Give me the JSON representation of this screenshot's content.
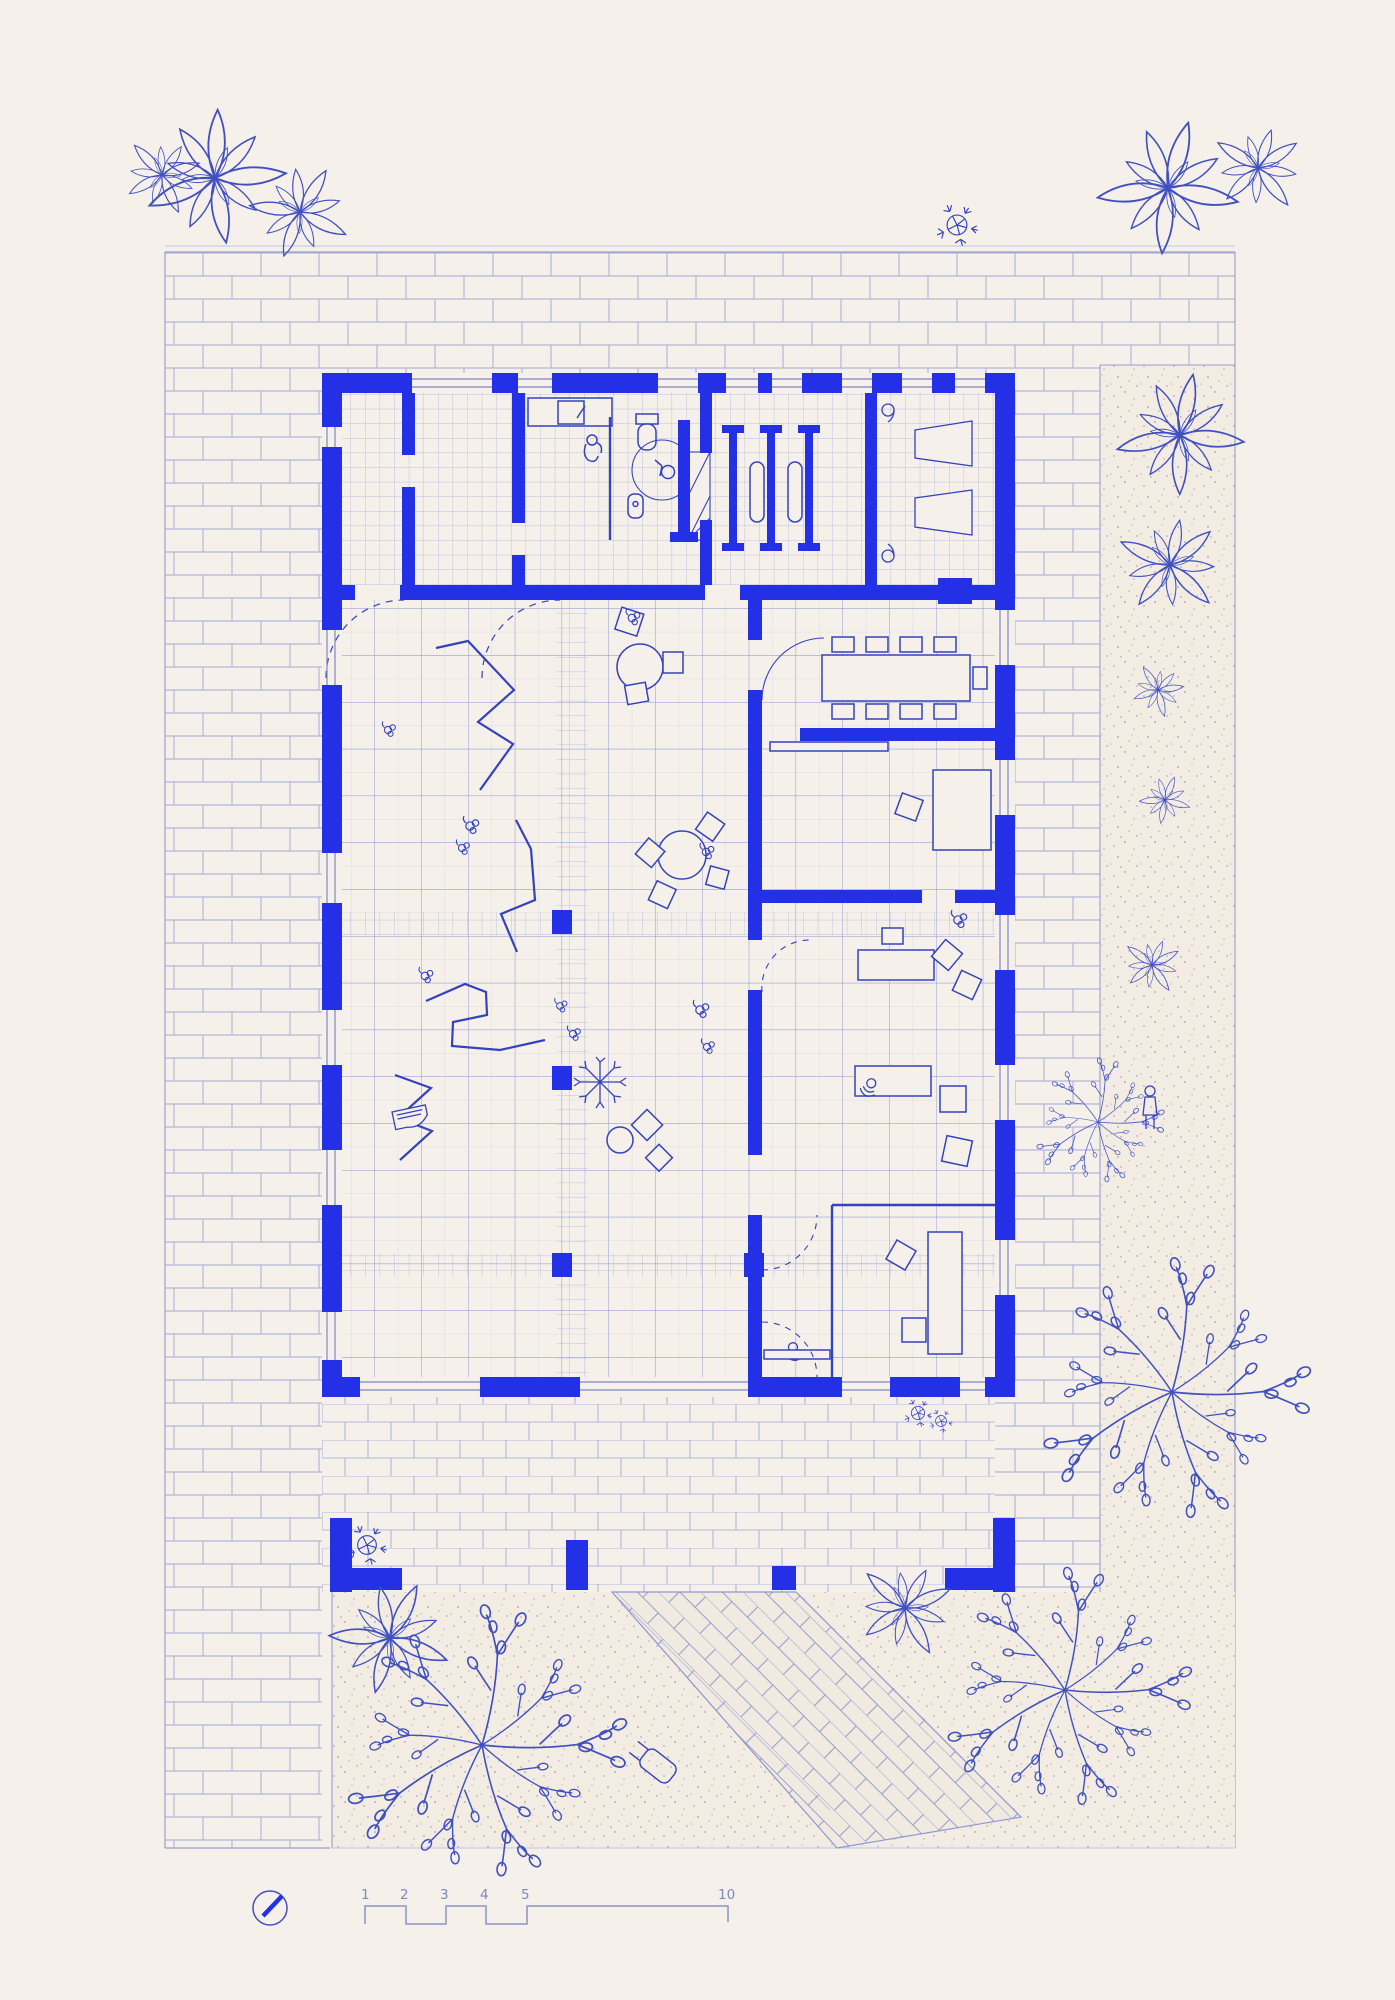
{
  "drawing": {
    "type": "architectural-site-floor-plan",
    "colors": {
      "background": "#f5f0e9",
      "wall_blue": "#2330e6",
      "sketch_blue": "#4050c0",
      "grid_blue": "#8d97d2",
      "brick_line": "#b3b7da",
      "stipple_dot": "#b9b2c6",
      "bed_background": "#f2ece3"
    }
  },
  "scale_bar": {
    "labels": [
      "1",
      "2",
      "3",
      "4",
      "5",
      "10"
    ]
  },
  "compass": {
    "icon": "north-arrow-icon"
  }
}
